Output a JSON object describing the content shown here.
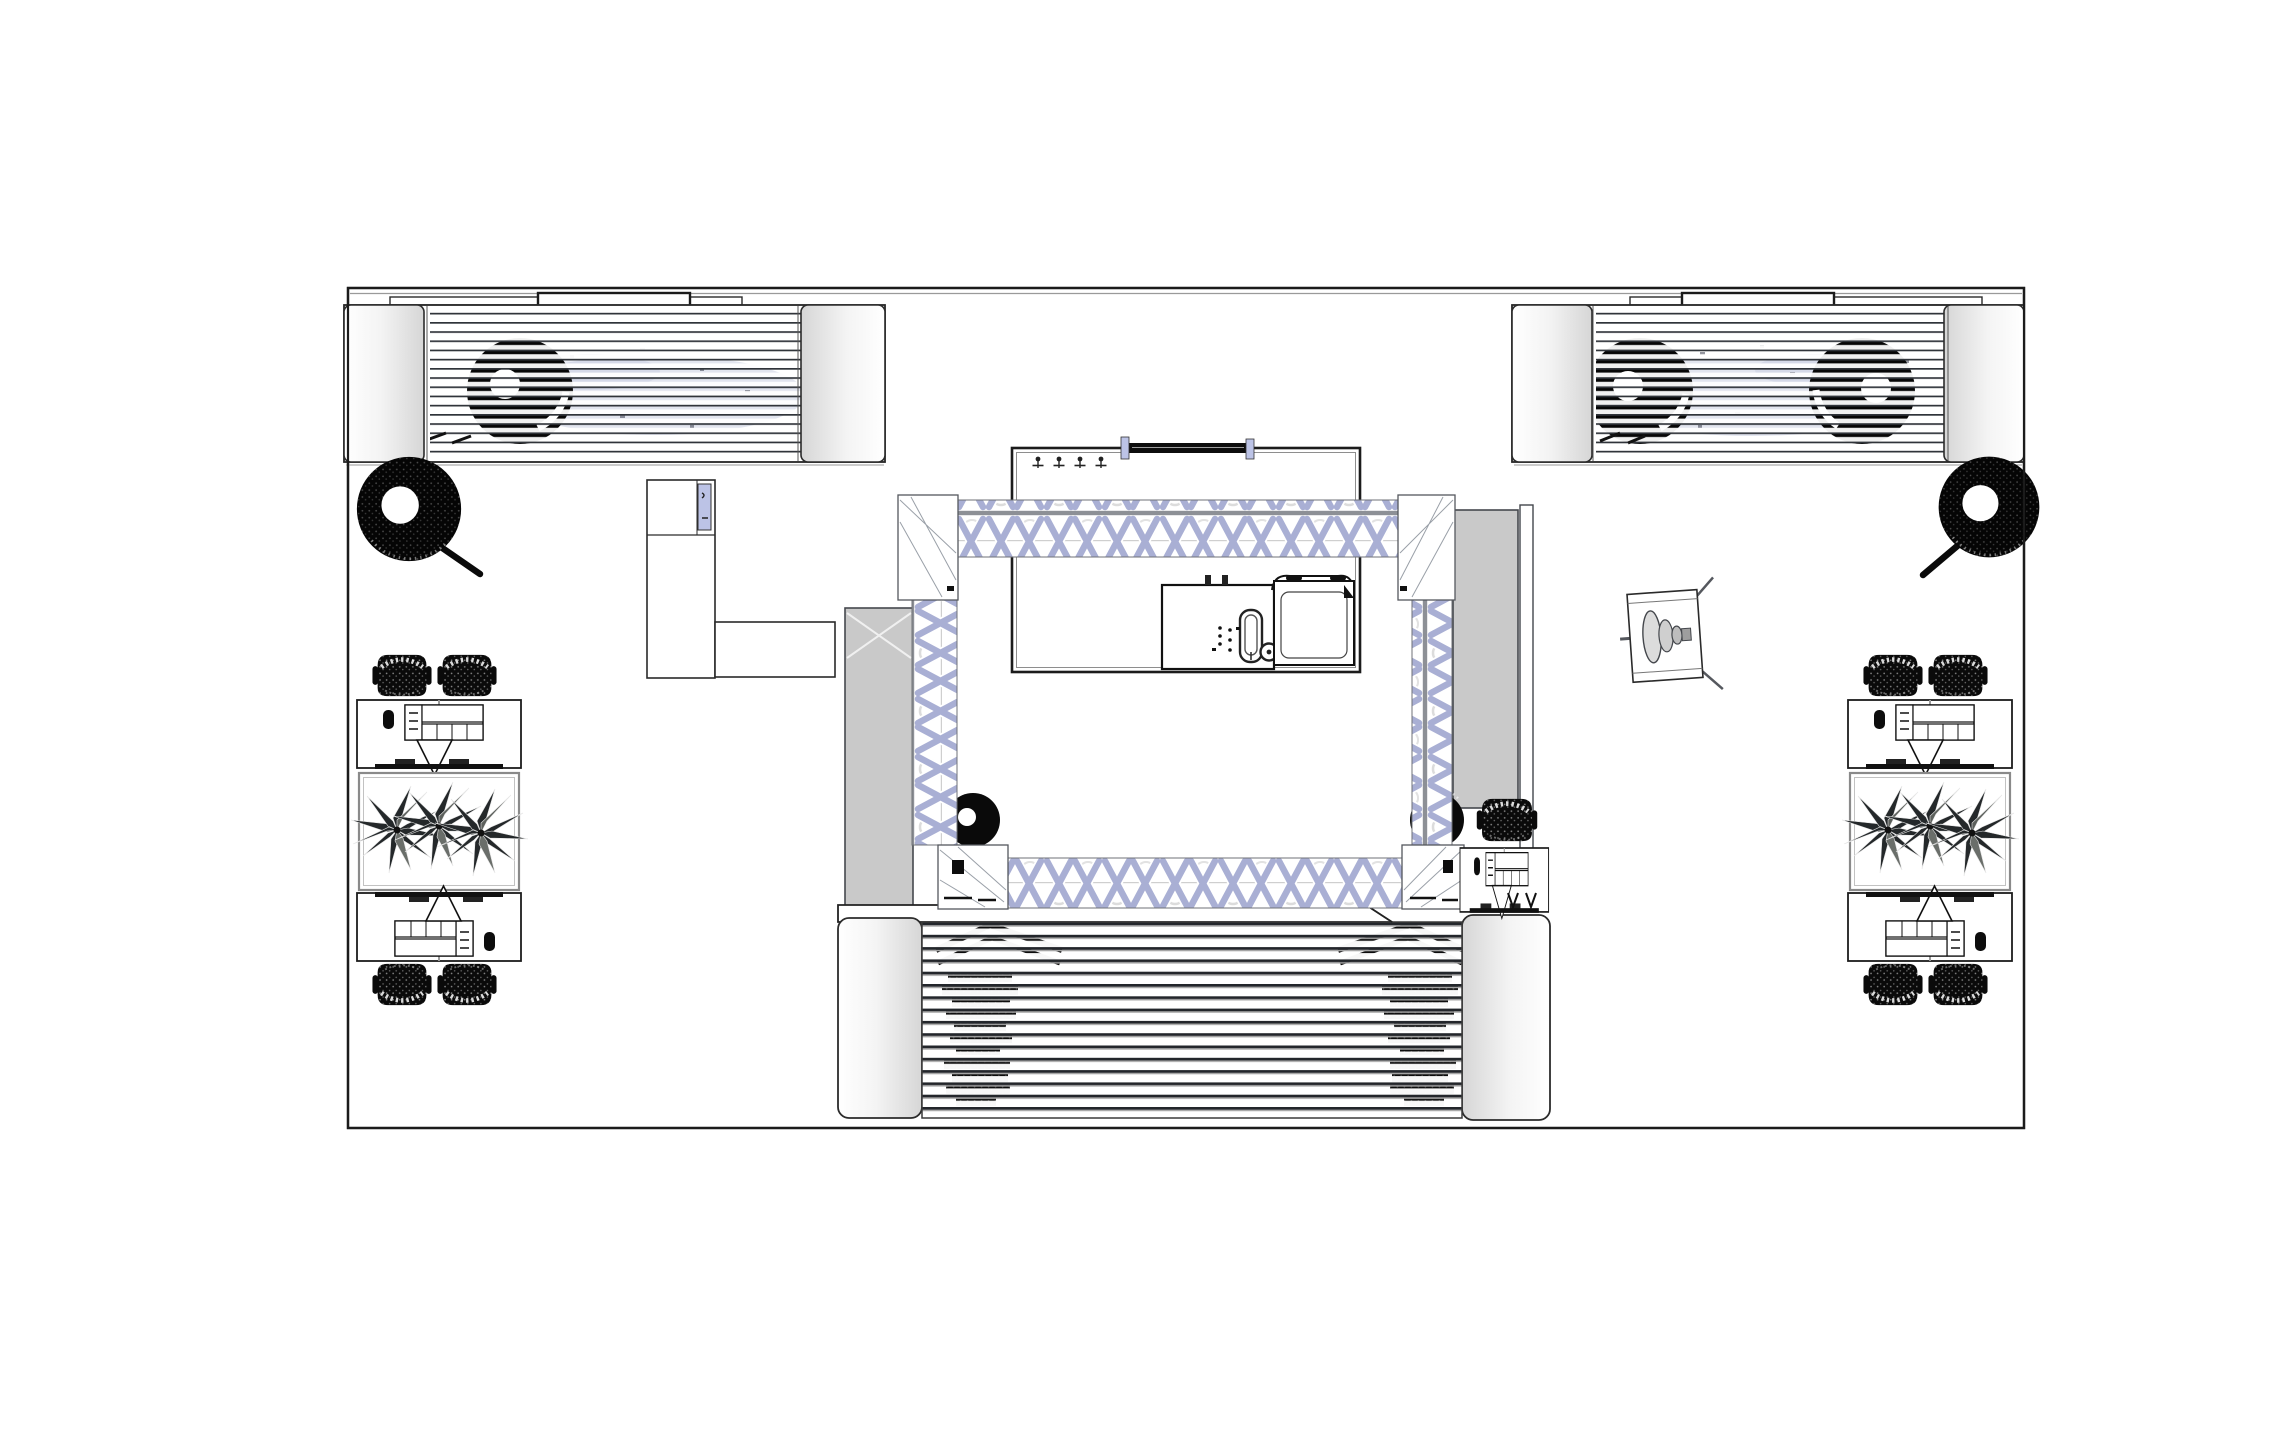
{
  "document": {
    "type": "cad-floor-plan-top-view",
    "description": "Top view technical drawing of an exhibition booth with two louvered car-display canopies, a central truss rig with enclosed room and kitchenette, a louvered stage with vehicle silhouettes, workstation islands with planters, display tires and a loudspeaker."
  },
  "colors": {
    "background": "#ffffff",
    "line": "#1c1c1c",
    "line_soft": "#8d9096",
    "truss": "#a9afd4",
    "accent_lavender": "#bcc3e6",
    "wall_gray": "#c9c9c9",
    "cap_gray": "#d6d6d6",
    "ink_black": "#0a0a0a",
    "car_ghost": "#b4bad6"
  },
  "components": {
    "booth_boundary": {
      "label": "Booth boundary outline"
    },
    "canopy_left": {
      "label": "Louvered canopy - car display (left)",
      "car_wheels_visible": 1
    },
    "canopy_right": {
      "label": "Louvered canopy - car display (right)",
      "car_wheels_visible": 2
    },
    "display_tire_left": {
      "label": "Display tire on stand (left)"
    },
    "display_tire_right": {
      "label": "Display tire on stand (right)"
    },
    "service_counter": {
      "label": "L-shaped service counter with lavender hatch"
    },
    "wall_panel_left": {
      "label": "Gray wall panel left of truss"
    },
    "wall_panel_right": {
      "label": "Gray wall panel right of truss"
    },
    "partition_wall_right": {
      "label": "Thin partition wall (right)"
    },
    "truss_frame": {
      "label": "Rectangular truss rig with corner blocks"
    },
    "corner_wheel_left": {
      "label": "Wheel at truss bottom-left corner"
    },
    "corner_wheel_right": {
      "label": "Wheel at truss bottom-right corner"
    },
    "meeting_room": {
      "label": "Enclosed room under truss"
    },
    "coat_hooks": {
      "label": "Coat hooks",
      "count": 4
    },
    "screen_bar": {
      "label": "Wall-mounted screen bar with clamps"
    },
    "kitchen_counter": {
      "label": "Kitchenette counter"
    },
    "sink": {
      "label": "Sink with faucet"
    },
    "appliance": {
      "label": "Top-opening appliance with lid"
    },
    "speaker": {
      "label": "Loudspeaker (top view)"
    },
    "stage": {
      "label": "Louvered stage canopy with end columns"
    },
    "vehicle_sil_left": {
      "label": "Vehicle silhouette under stage louvers (left)"
    },
    "vehicle_sil_right": {
      "label": "Vehicle silhouette under stage louvers (right)"
    },
    "table_group_left": {
      "label": "Workstation island with planter (left)",
      "chairs": 4,
      "desks": 2
    },
    "table_group_right": {
      "label": "Workstation island with planter (right)",
      "chairs": 4,
      "desks": 2
    },
    "workstation_single": {
      "label": "Single workstation beside stage",
      "chairs": 1,
      "desks": 1
    }
  },
  "counts": {
    "chairs": 9,
    "desks": 5,
    "planters": 2,
    "coat_hooks": 4,
    "display_tires": 2,
    "speakers": 1,
    "canopies": 2
  }
}
